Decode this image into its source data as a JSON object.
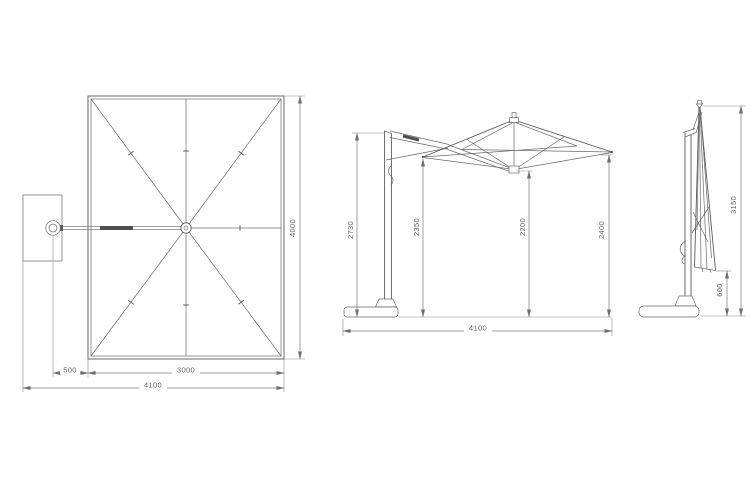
{
  "title": "cantilever-parasol-technical-drawing",
  "colors": {
    "line": "#5a5a5a",
    "dimension": "#777777",
    "text": "#5f5f5f",
    "background": "#ffffff"
  },
  "top_view": {
    "canopy_width": "3000",
    "canopy_depth": "4000",
    "pole_offset": "500",
    "overall_width": "4100"
  },
  "front_view": {
    "pole_height": "2730",
    "left_edge_height": "2350",
    "center_clearance": "2200",
    "right_edge_height": "2400",
    "overall_width": "4100"
  },
  "side_view_closed": {
    "overall_height": "3150",
    "stack_clearance": "600"
  }
}
